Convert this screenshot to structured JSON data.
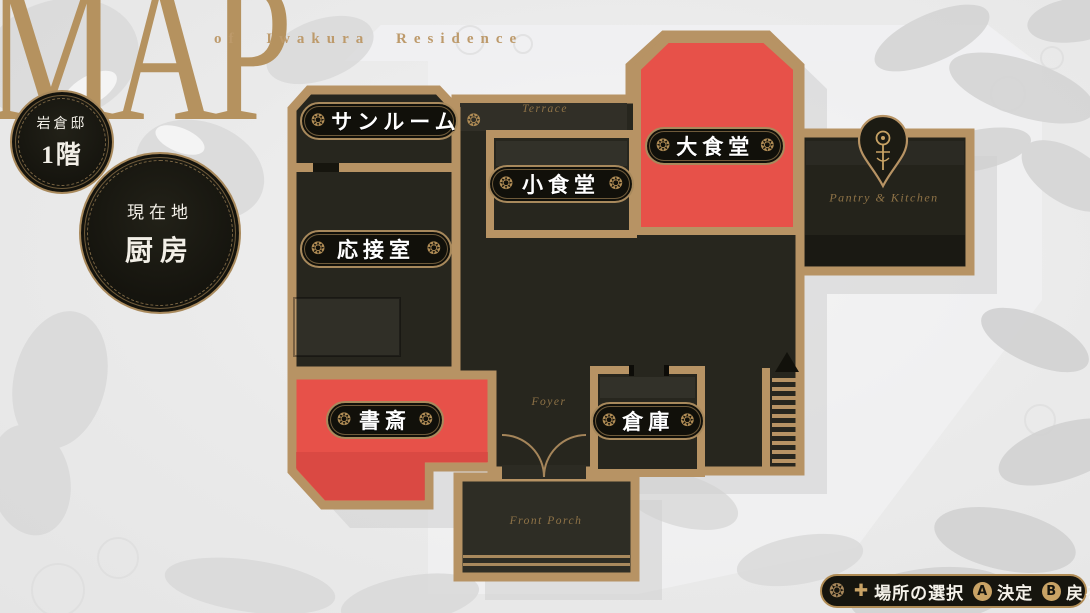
{
  "header": {
    "logo": "MAP",
    "subtitle": "of Iwakura Residence"
  },
  "badges": {
    "floor_badge": {
      "line1": "岩倉邸",
      "line2": "1階"
    },
    "location_badge": {
      "line1": "現在地",
      "line2": "厨房"
    }
  },
  "map": {
    "rooms": [
      {
        "id": "sunroom",
        "label": "サンルーム",
        "state": "normal"
      },
      {
        "id": "reception-room",
        "label": "応接室",
        "state": "normal"
      },
      {
        "id": "small-dining-room",
        "label": "小食堂",
        "state": "normal"
      },
      {
        "id": "grand-dining-room",
        "label": "大食堂",
        "state": "highlighted"
      },
      {
        "id": "study",
        "label": "書斎",
        "state": "highlighted"
      },
      {
        "id": "storage-room",
        "label": "倉庫",
        "state": "normal"
      }
    ],
    "areas": {
      "terrace": "Terrace",
      "foyer": "Foyer",
      "front_porch": "Front Porch",
      "pantry_kitchen": "Pantry & Kitchen"
    }
  },
  "controls_bar": {
    "dpad_glyph": "✚",
    "items": [
      {
        "button": "",
        "label": "場所の選択"
      },
      {
        "button": "A",
        "label": "決定"
      },
      {
        "button": "B",
        "label": "戻る"
      }
    ]
  },
  "decor": {
    "rosette": "❂"
  },
  "colors": {
    "wall_gold": "#b79364",
    "room_dark": "#27261e",
    "highlight_red": "#e75149",
    "background": "#e9e9e9",
    "gold_text": "#8f7347"
  }
}
